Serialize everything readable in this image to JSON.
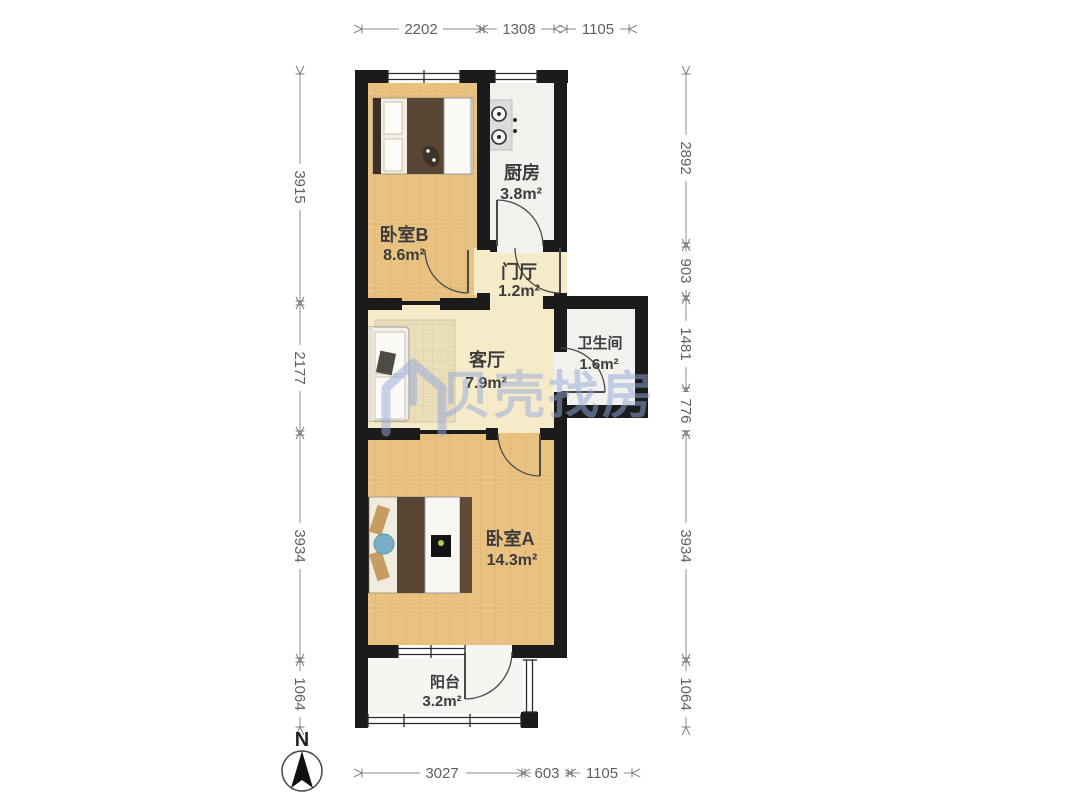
{
  "title": "apartment-floor-plan",
  "watermark": {
    "text": "贝壳找房",
    "color": "#93a9dc"
  },
  "north": {
    "label": "N"
  },
  "rooms": {
    "bedroomB": {
      "name": "卧室B",
      "area": "8.6m²"
    },
    "kitchen": {
      "name": "厨房",
      "area": "3.8m²"
    },
    "hall": {
      "name": "门厅",
      "area": "1.2m²"
    },
    "living": {
      "name": "客厅",
      "area": "7.9m²"
    },
    "bathroom": {
      "name": "卫生间",
      "area": "1.6m²"
    },
    "bedroomA": {
      "name": "卧室A",
      "area": "14.3m²"
    },
    "balcony": {
      "name": "阳台",
      "area": "3.2m²"
    }
  },
  "dims": {
    "top": [
      "2202",
      "1308",
      "1105"
    ],
    "bottom": [
      "3027",
      "603",
      "1105"
    ],
    "left": [
      "3915",
      "2177",
      "3934",
      "1064"
    ],
    "right": [
      "2892",
      "903",
      "1481",
      "776",
      "3934",
      "1064"
    ]
  },
  "colors": {
    "wall": "#1b1b1b",
    "wood_floor": "#e9c181",
    "cream_floor": "#f6ebc9",
    "tile_floor": "#f1f1ed",
    "balcony_floor": "#f5f5f2",
    "dimension_line": "#8c8c8c",
    "watermark_blue": "#93a9dc"
  }
}
